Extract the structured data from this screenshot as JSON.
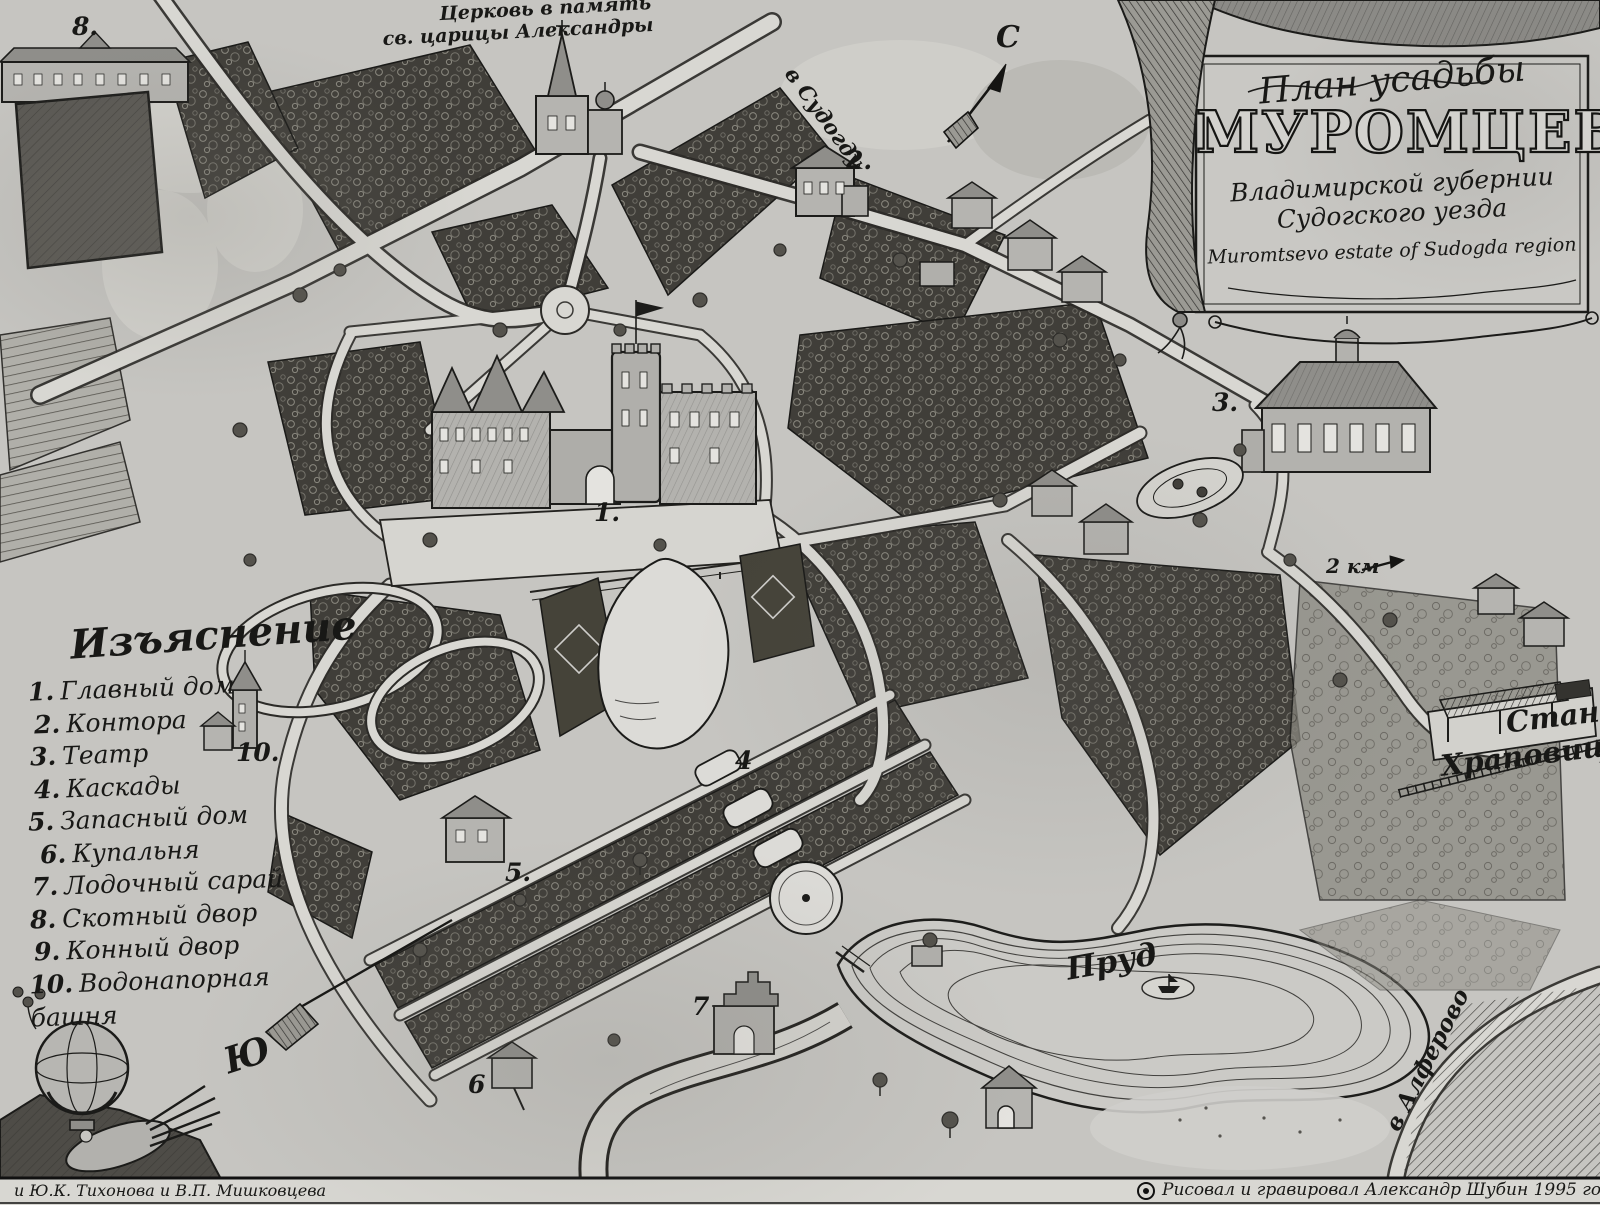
{
  "cartouche": {
    "line1": "План усадьбы",
    "title": "МУРОМЦЕВО",
    "line3": "Владимирской губернии",
    "line4": "Судогского уезда",
    "line5": "Muromtsevo estate of Sudogda region"
  },
  "legend": {
    "heading": "Изъяснение",
    "items": [
      {
        "num": "1.",
        "label": "Главный дом"
      },
      {
        "num": "2.",
        "label": "Контора"
      },
      {
        "num": "3.",
        "label": "Театр"
      },
      {
        "num": "4.",
        "label": "Каскады"
      },
      {
        "num": "5.",
        "label": "Запасный дом"
      },
      {
        "num": "6.",
        "label": "Купальня"
      },
      {
        "num": "7.",
        "label": "Лодочный сарай"
      },
      {
        "num": "8.",
        "label": "Скотный двор"
      },
      {
        "num": "9.",
        "label": "Конный двор"
      },
      {
        "num": "10.",
        "label": "Водонапорная башня"
      }
    ]
  },
  "labels": {
    "church_line1": "Церковь в память",
    "church_line2": "св. царицы Александры",
    "to_sudogda": "в Судогду",
    "to_alferovo": "в Алферово",
    "pond": "Пруд",
    "station_line1": "Станция",
    "station_line2": "Храповицкая",
    "scale": "2 км",
    "compass_north": "С",
    "compass_south": "Ю"
  },
  "markers": [
    "1.",
    "2.",
    "3.",
    "4",
    "5.",
    "6",
    "7",
    "8.",
    "10."
  ],
  "credits": {
    "left": "и Ю.К. Тихонова и В.П. Мишковцева",
    "right": "Рисовал и гравировал Александр Шубин 1995 год."
  },
  "palette": {
    "paper": "#c6c5c1",
    "ink": "#1b1b19",
    "parcel_dark": "#403e39",
    "path_light": "#d8d7d2",
    "water": "#dcdbd7"
  }
}
